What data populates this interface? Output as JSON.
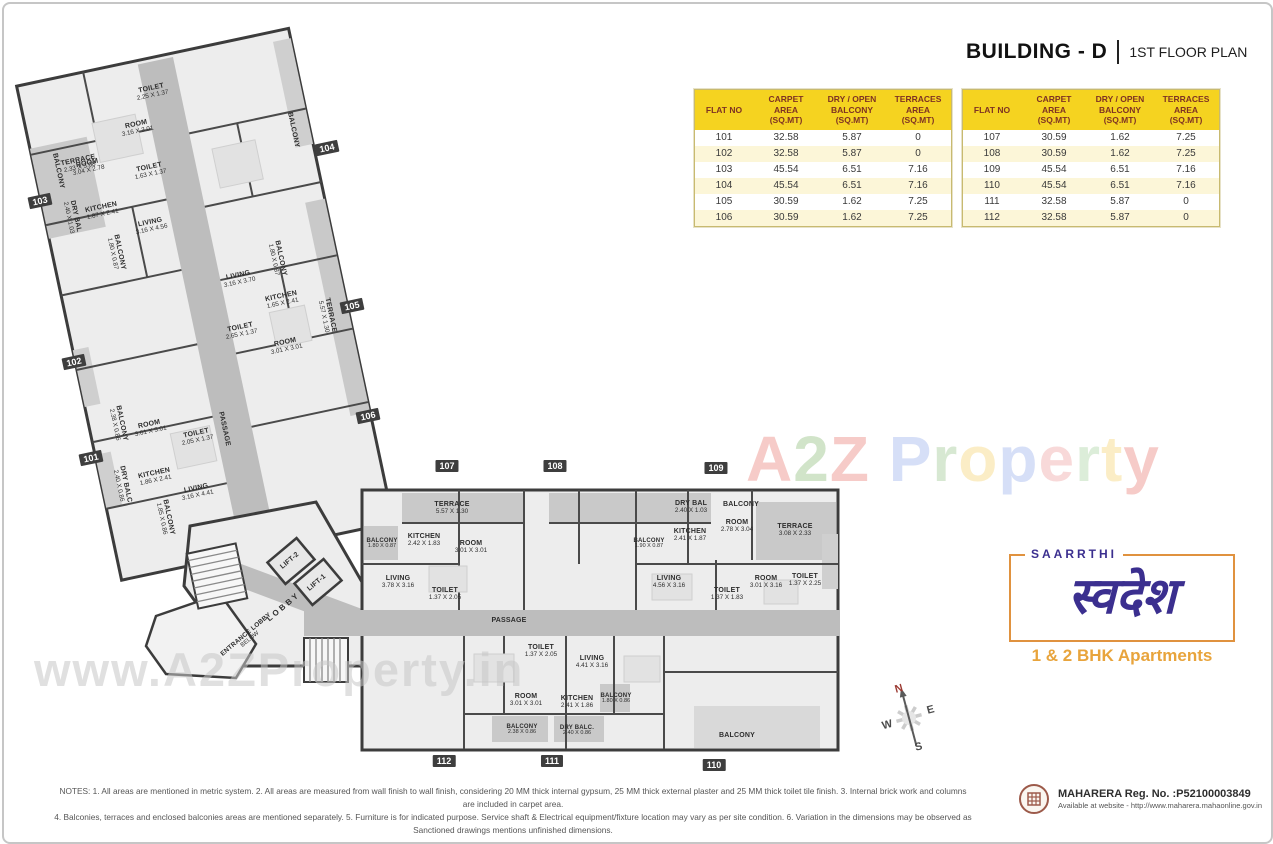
{
  "header": {
    "building": "BUILDING - D",
    "plan": "1ST FLOOR PLAN"
  },
  "table": {
    "headers": [
      "FLAT NO",
      "CARPET\nAREA\n(SQ.MT)",
      "DRY / OPEN\nBALCONY\n(SQ.MT)",
      "TERRACES\nAREA\n(SQ.MT)"
    ],
    "left_rows": [
      [
        "101",
        "32.58",
        "5.87",
        "0"
      ],
      [
        "102",
        "32.58",
        "5.87",
        "0"
      ],
      [
        "103",
        "45.54",
        "6.51",
        "7.16"
      ],
      [
        "104",
        "45.54",
        "6.51",
        "7.16"
      ],
      [
        "105",
        "30.59",
        "1.62",
        "7.25"
      ],
      [
        "106",
        "30.59",
        "1.62",
        "7.25"
      ]
    ],
    "right_rows": [
      [
        "107",
        "30.59",
        "1.62",
        "7.25"
      ],
      [
        "108",
        "30.59",
        "1.62",
        "7.25"
      ],
      [
        "109",
        "45.54",
        "6.51",
        "7.16"
      ],
      [
        "110",
        "45.54",
        "6.51",
        "7.16"
      ],
      [
        "111",
        "32.58",
        "5.87",
        "0"
      ],
      [
        "112",
        "32.58",
        "5.87",
        "0"
      ]
    ]
  },
  "floor_plan": {
    "flat_markers": [
      {
        "no": "103",
        "x": 36,
        "y": 197,
        "r": -12
      },
      {
        "no": "102",
        "x": 70,
        "y": 358,
        "r": -12
      },
      {
        "no": "101",
        "x": 87,
        "y": 454,
        "r": -12
      },
      {
        "no": "104",
        "x": 323,
        "y": 144,
        "r": -12
      },
      {
        "no": "105",
        "x": 348,
        "y": 302,
        "r": -12
      },
      {
        "no": "106",
        "x": 364,
        "y": 412,
        "r": -12
      },
      {
        "no": "107",
        "x": 443,
        "y": 462,
        "r": 0
      },
      {
        "no": "108",
        "x": 551,
        "y": 462,
        "r": 0
      },
      {
        "no": "109",
        "x": 712,
        "y": 464,
        "r": 0
      },
      {
        "no": "110",
        "x": 710,
        "y": 761,
        "r": 0
      },
      {
        "no": "111",
        "x": 548,
        "y": 757,
        "r": 0
      },
      {
        "no": "112",
        "x": 440,
        "y": 757,
        "r": 0
      }
    ],
    "labels": [
      {
        "name": "TERRACE",
        "dim": "2.33 X 3.08",
        "x": 75,
        "y": 160,
        "r": -12
      },
      {
        "name": "TOILET",
        "dim": "2.25 X 1.37",
        "x": 148,
        "y": 88,
        "r": -12
      },
      {
        "name": "ROOM",
        "dim": "3.16 X 3.01",
        "x": 133,
        "y": 124,
        "r": -12
      },
      {
        "name": "BALCONY",
        "dim": "",
        "x": 54,
        "y": 167,
        "r": 78
      },
      {
        "name": "ROOM",
        "dim": "3.04 X 2.78",
        "x": 84,
        "y": 163,
        "r": -12
      },
      {
        "name": "TOILET",
        "dim": "1.63 X 1.37",
        "x": 146,
        "y": 167,
        "r": -12
      },
      {
        "name": "DRY BAL",
        "dim": "2.40 X 1.03",
        "x": 68,
        "y": 213,
        "r": 78
      },
      {
        "name": "KITCHEN",
        "dim": "1.87 X 2.41",
        "x": 98,
        "y": 207,
        "r": -12
      },
      {
        "name": "LIVING",
        "dim": "3.16 X 4.56",
        "x": 147,
        "y": 222,
        "r": -12
      },
      {
        "name": "BALCONY",
        "dim": "",
        "x": 289,
        "y": 126,
        "r": 78
      },
      {
        "name": "BALCONY",
        "dim": "1.80 X 0.87",
        "x": 112,
        "y": 249,
        "r": 78
      },
      {
        "name": "BALCONY",
        "dim": "1.80 X 0.87",
        "x": 273,
        "y": 255,
        "r": 78
      },
      {
        "name": "LIVING",
        "dim": "3.16 X 3.70",
        "x": 235,
        "y": 275,
        "r": -12
      },
      {
        "name": "KITCHEN",
        "dim": "1.65 X 2.41",
        "x": 278,
        "y": 296,
        "r": -12
      },
      {
        "name": "TERRACE",
        "dim": "5.57 X 1.30",
        "x": 323,
        "y": 312,
        "r": 78
      },
      {
        "name": "TOILET",
        "dim": "2.65 X 1.37",
        "x": 237,
        "y": 327,
        "r": -12
      },
      {
        "name": "ROOM",
        "dim": "3.01 X 3.01",
        "x": 282,
        "y": 342,
        "r": -12
      },
      {
        "name": "PASSAGE",
        "dim": "",
        "x": 220,
        "y": 425,
        "r": 78
      },
      {
        "name": "ROOM",
        "dim": "3.01 X 3.01",
        "x": 146,
        "y": 424,
        "r": -12
      },
      {
        "name": "TOILET",
        "dim": "2.05 X 1.37",
        "x": 193,
        "y": 433,
        "r": -12
      },
      {
        "name": "BALCONY",
        "dim": "2.38 X 0.86",
        "x": 114,
        "y": 420,
        "r": 78
      },
      {
        "name": "DRY BALC",
        "dim": "2.40 X 0.86",
        "x": 118,
        "y": 481,
        "r": 78
      },
      {
        "name": "KITCHEN",
        "dim": "1.86 X 2.41",
        "x": 151,
        "y": 473,
        "r": -12
      },
      {
        "name": "LIVING",
        "dim": "3.16 X 4.41",
        "x": 193,
        "y": 488,
        "r": -12
      },
      {
        "name": "BALCONY",
        "dim": "1.85 X 0.86",
        "x": 161,
        "y": 514,
        "r": 78
      },
      {
        "name": "LIFT-2",
        "dim": "",
        "x": 286,
        "y": 557,
        "r": -40
      },
      {
        "name": "LIFT-1",
        "dim": "",
        "x": 313,
        "y": 579,
        "r": -40
      },
      {
        "name": "L O B B Y",
        "dim": "",
        "x": 279,
        "y": 604,
        "r": -40,
        "fs": 8
      },
      {
        "name": "ENTRANCE LOBBY",
        "dim": "BELOW",
        "x": 244,
        "y": 633,
        "r": -40,
        "fs": 6.5
      },
      {
        "name": "TERRACE",
        "dim": "5.57 X 1.30",
        "x": 448,
        "y": 504,
        "r": 0
      },
      {
        "name": "BALCONY",
        "dim": "1.80 X 0.87",
        "x": 378,
        "y": 540,
        "r": 0,
        "fs": 6
      },
      {
        "name": "KITCHEN",
        "dim": "2.42 X 1.83",
        "x": 420,
        "y": 536,
        "r": 0
      },
      {
        "name": "ROOM",
        "dim": "3.01 X 3.01",
        "x": 467,
        "y": 543,
        "r": 0
      },
      {
        "name": "LIVING",
        "dim": "3.78 X 3.16",
        "x": 394,
        "y": 578,
        "r": 0
      },
      {
        "name": "TOILET",
        "dim": "1.37 X 2.05",
        "x": 441,
        "y": 590,
        "r": 0
      },
      {
        "name": "PASSAGE",
        "dim": "",
        "x": 505,
        "y": 617,
        "r": 0
      },
      {
        "name": "BALCONY",
        "dim": "1.90 X 0.87",
        "x": 645,
        "y": 540,
        "r": 0,
        "fs": 6
      },
      {
        "name": "DRY BAL",
        "dim": "2.40 X 1.03",
        "x": 687,
        "y": 503,
        "r": 0
      },
      {
        "name": "BALCONY",
        "dim": "",
        "x": 737,
        "y": 501,
        "r": 0
      },
      {
        "name": "ROOM",
        "dim": "2.78 X 3.04",
        "x": 733,
        "y": 522,
        "r": 0
      },
      {
        "name": "TERRACE",
        "dim": "3.08 X 2.33",
        "x": 791,
        "y": 526,
        "r": 0
      },
      {
        "name": "KITCHEN",
        "dim": "2.41 X 1.87",
        "x": 686,
        "y": 531,
        "r": 0
      },
      {
        "name": "LIVING",
        "dim": "4.56 X 3.16",
        "x": 665,
        "y": 578,
        "r": 0
      },
      {
        "name": "TOILET",
        "dim": "1.37 X 1.83",
        "x": 723,
        "y": 590,
        "r": 0
      },
      {
        "name": "ROOM",
        "dim": "3.01 X 3.16",
        "x": 762,
        "y": 578,
        "r": 0
      },
      {
        "name": "TOILET",
        "dim": "1.37 X 2.25",
        "x": 801,
        "y": 576,
        "r": 0
      },
      {
        "name": "TOILET",
        "dim": "1.37 X 2.05",
        "x": 537,
        "y": 647,
        "r": 0
      },
      {
        "name": "LIVING",
        "dim": "4.41 X 3.16",
        "x": 588,
        "y": 658,
        "r": 0
      },
      {
        "name": "ROOM",
        "dim": "3.01 X 3.01",
        "x": 522,
        "y": 696,
        "r": 0
      },
      {
        "name": "KITCHEN",
        "dim": "2.41 X 1.86",
        "x": 573,
        "y": 698,
        "r": 0
      },
      {
        "name": "BALCONY",
        "dim": "1.80 X 0.86",
        "x": 612,
        "y": 695,
        "r": 0,
        "fs": 6
      },
      {
        "name": "BALCONY",
        "dim": "2.38 X 0.86",
        "x": 518,
        "y": 726,
        "r": 0,
        "fs": 6
      },
      {
        "name": "DRY BALC.",
        "dim": "2.40 X 0.86",
        "x": 573,
        "y": 727,
        "r": 0,
        "fs": 6
      },
      {
        "name": "BALCONY",
        "dim": "",
        "x": 733,
        "y": 732,
        "r": 0
      }
    ]
  },
  "compass": {
    "north": "N",
    "east": "E",
    "west": "W",
    "south": "S"
  },
  "watermarks": {
    "brand_letters": [
      {
        "ch": "A",
        "color": "#e2574c"
      },
      {
        "ch": "2",
        "color": "#6aa84f"
      },
      {
        "ch": "Z",
        "color": "#e2574c"
      },
      {
        "ch": " ",
        "color": "#000000"
      },
      {
        "ch": "P",
        "color": "#7a97e6"
      },
      {
        "ch": "r",
        "color": "#7cb56d"
      },
      {
        "ch": "o",
        "color": "#f2c744"
      },
      {
        "ch": "p",
        "color": "#7a97e6"
      },
      {
        "ch": "e",
        "color": "#e98484"
      },
      {
        "ch": "r",
        "color": "#8fc483"
      },
      {
        "ch": "t",
        "color": "#f2c744"
      },
      {
        "ch": "y",
        "color": "#e2574c"
      }
    ],
    "url": "www.A2ZProperty.in"
  },
  "logo": {
    "brand": "SAARRTHI",
    "wordmark": "स्वदेश",
    "tagline": "1 & 2 BHK Apartments"
  },
  "notes": {
    "line1": "NOTES: 1. All areas are mentioned in metric system.   2. All areas are measured from wall finish to wall finish, considering 20 MM thick internal gypsum, 25 MM thick external plaster and 25 MM thick toilet tile finish.   3. Internal brick work and columns are included in carpet area.",
    "line2": "4. Balconies, terraces and enclosed balconies areas are mentioned separately.   5. Furniture is for indicated purpose. Service shaft & Electrical equipment/fixture location may vary as per site condition.   6. Variation in the dimensions may be observed as Sanctioned drawings mentions unfinished dimensions."
  },
  "rera": {
    "line1": "MAHARERA Reg. No. :P52100003849",
    "line2": "Available at website - http://www.maharera.mahaonline.gov.in"
  }
}
